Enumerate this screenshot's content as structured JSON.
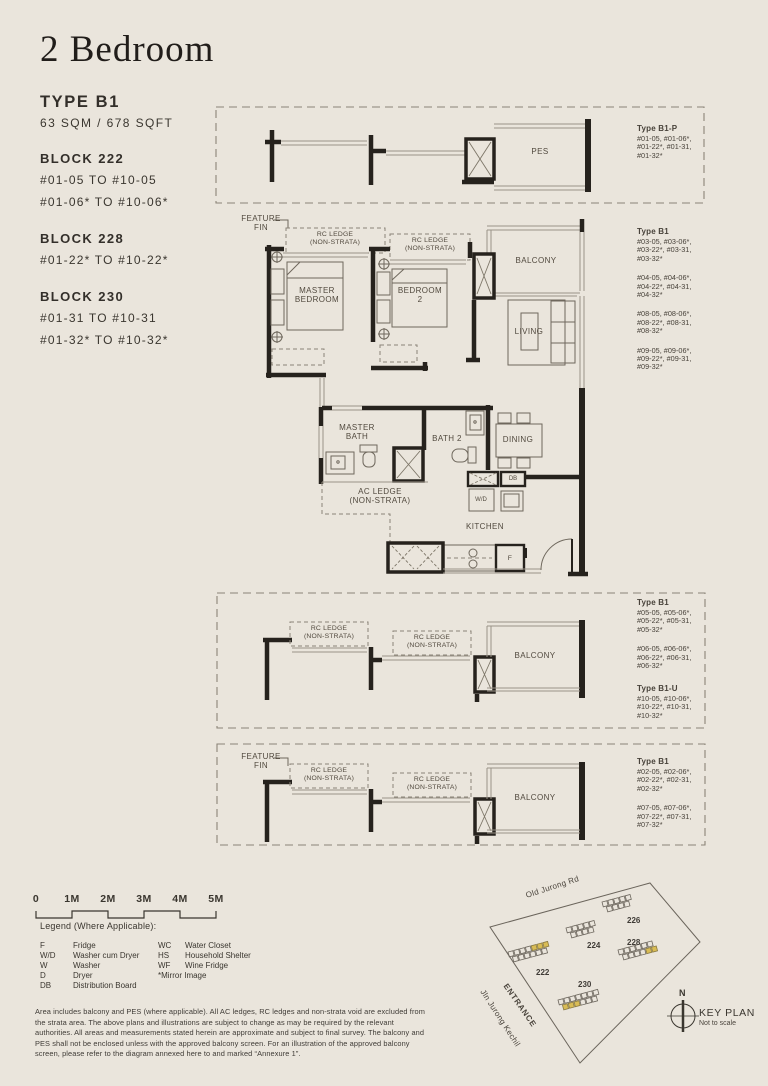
{
  "header": {
    "title": "2 Bedroom"
  },
  "unit": {
    "type": "TYPE B1",
    "area": "63 SQM / 678 SQFT"
  },
  "blocks": [
    {
      "name": "BLOCK 222",
      "lines": [
        "#01-05 TO #10-05",
        "#01-06* TO #10-06*"
      ]
    },
    {
      "name": "BLOCK 228",
      "lines": [
        "#01-22* TO #10-22*"
      ]
    },
    {
      "name": "BLOCK 230",
      "lines": [
        "#01-31 TO #10-31",
        "#01-32* TO #10-32*"
      ]
    }
  ],
  "plan": {
    "labels": {
      "pes": "PES",
      "feature_fin": "FEATURE\nFIN",
      "rc_ledge": "RC LEDGE\n(NON-STRATA)",
      "balcony": "BALCONY",
      "master_bedroom": "MASTER\nBEDROOM",
      "bedroom2": "BEDROOM\n2",
      "living": "LIVING",
      "master_bath": "MASTER\nBATH",
      "bath2": "BATH 2",
      "dining": "DINING",
      "db": "DB",
      "wd": "W/D",
      "ac_ledge": "AC LEDGE\n(NON-STRATA)",
      "kitchen": "KITCHEN",
      "fridge": "F"
    }
  },
  "callouts": {
    "b1p": {
      "title": "Type B1-P",
      "groups": [
        "#01-05, #01-06*,\n#01-22*, #01-31,\n#01-32*"
      ]
    },
    "main": {
      "title": "Type B1",
      "groups": [
        "#03-05, #03-06*,\n#03-22*, #03-31,\n#03-32*",
        "#04-05, #04-06*,\n#04-22*, #04-31,\n#04-32*",
        "#08-05, #08-06*,\n#08-22*, #08-31,\n#08-32*",
        "#09-05, #09-06*,\n#09-22*, #09-31,\n#09-32*"
      ]
    },
    "mid": {
      "title": "Type B1",
      "groups": [
        "#05-05, #05-06*,\n#05-22*, #05-31,\n#05-32*",
        "#06-05, #06-06*,\n#06-22*, #06-31,\n#06-32*"
      ]
    },
    "mid_u": {
      "title": "Type B1-U",
      "groups": [
        "#10-05, #10-06*,\n#10-22*, #10-31,\n#10-32*"
      ]
    },
    "bottom": {
      "title": "Type B1",
      "groups": [
        "#02-05, #02-06*,\n#02-22*, #02-31,\n#02-32*",
        "#07-05, #07-06*,\n#07-22*, #07-31,\n#07-32*"
      ]
    }
  },
  "scalebar": {
    "labels": [
      "0",
      "1M",
      "2M",
      "3M",
      "4M",
      "5M"
    ]
  },
  "legend": {
    "title": "Legend (Where Applicable):",
    "left": [
      {
        "k": "F",
        "v": "Fridge"
      },
      {
        "k": "W/D",
        "v": "Washer cum Dryer"
      },
      {
        "k": "W",
        "v": "Washer"
      },
      {
        "k": "D",
        "v": "Dryer"
      },
      {
        "k": "DB",
        "v": "Distribution Board"
      }
    ],
    "right": [
      {
        "k": "WC",
        "v": "Water Closet"
      },
      {
        "k": "HS",
        "v": "Household Shelter"
      },
      {
        "k": "WF",
        "v": "Wine Fridge"
      },
      {
        "k": "*Mirror Image",
        "v": ""
      }
    ]
  },
  "disclaimer": "Area includes balcony and PES (where applicable). All AC ledges, RC ledges and non-strata void are excluded from the strata area. The above plans and illustrations are subject to change as may be required by the relevant authorities. All areas and measurements stated herein are approximate and subject to final survey. The balcony and PES shall not be enclosed unless with the approved balcony screen. For an illustration of the approved balcony screen, please refer to the diagram annexed here to and marked “Annexure 1”.",
  "keyplan": {
    "roads": [
      "Old Jurong Rd",
      "Jln Jurong Kechil"
    ],
    "entrance": "ENTRANCE",
    "blocks": [
      "222",
      "224",
      "226",
      "228",
      "230"
    ],
    "north": "N",
    "title": "KEY PLAN",
    "note": "Not to scale",
    "highlight_color": "#d9bc55"
  }
}
